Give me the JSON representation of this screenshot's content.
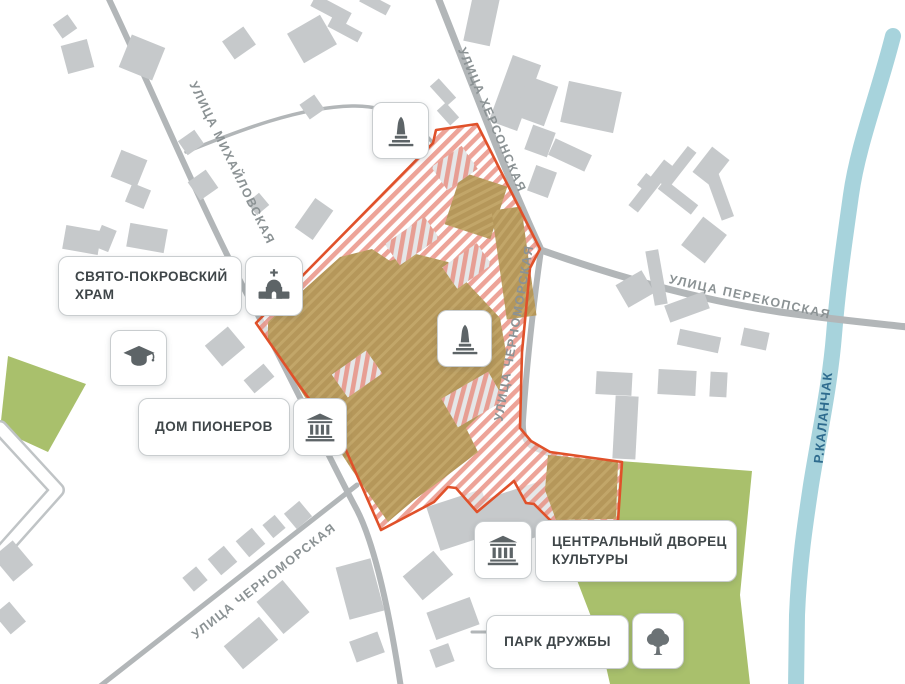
{
  "map": {
    "streets": [
      {
        "name": "УЛИЦА МИХАЙЛОВСКАЯ"
      },
      {
        "name": "УЛИЦА ХЕРСОНСКАЯ"
      },
      {
        "name": "УЛИЦА ПЕРЕКОПСКАЯ"
      },
      {
        "name": "УЛИЦА ЧЕРНОМОРСКАЯ"
      },
      {
        "name": "УЛИЦА ЧЕРНОМОРСКАЯ"
      }
    ],
    "river": {
      "name": "Р.КАЛАНЧАК"
    },
    "pois": {
      "church": {
        "label": "СВЯТО-ПОКРОВСКИЙ\nХРАМ",
        "icon": "church-icon"
      },
      "pioneers": {
        "label": "ДОМ ПИОНЕРОВ",
        "icon": "classical-building-icon"
      },
      "palace": {
        "label": "ЦЕНТРАЛЬНЫЙ ДВОРЕЦ\nКУЛЬТУРЫ",
        "icon": "classical-building-icon"
      },
      "park": {
        "label": "ПАРК ДРУЖБЫ",
        "icon": "tree-icon"
      }
    },
    "markers": [
      {
        "icon": "monument-icon"
      },
      {
        "icon": "monument-icon"
      },
      {
        "icon": "education-icon"
      }
    ],
    "colors": {
      "highlight_border": "#e0512a",
      "highlight_hatch": "#e8897b",
      "site_building_olive": "#b5975a",
      "building_gray": "#c6c9cb",
      "road_gray": "#b2b6b8",
      "green_area": "#a9c06c",
      "river_blue": "#a7d3dc",
      "river_text": "#2e6b8e",
      "label_text": "#3f4649",
      "street_text": "#8b9294",
      "icon_gray": "#5d6467"
    }
  }
}
